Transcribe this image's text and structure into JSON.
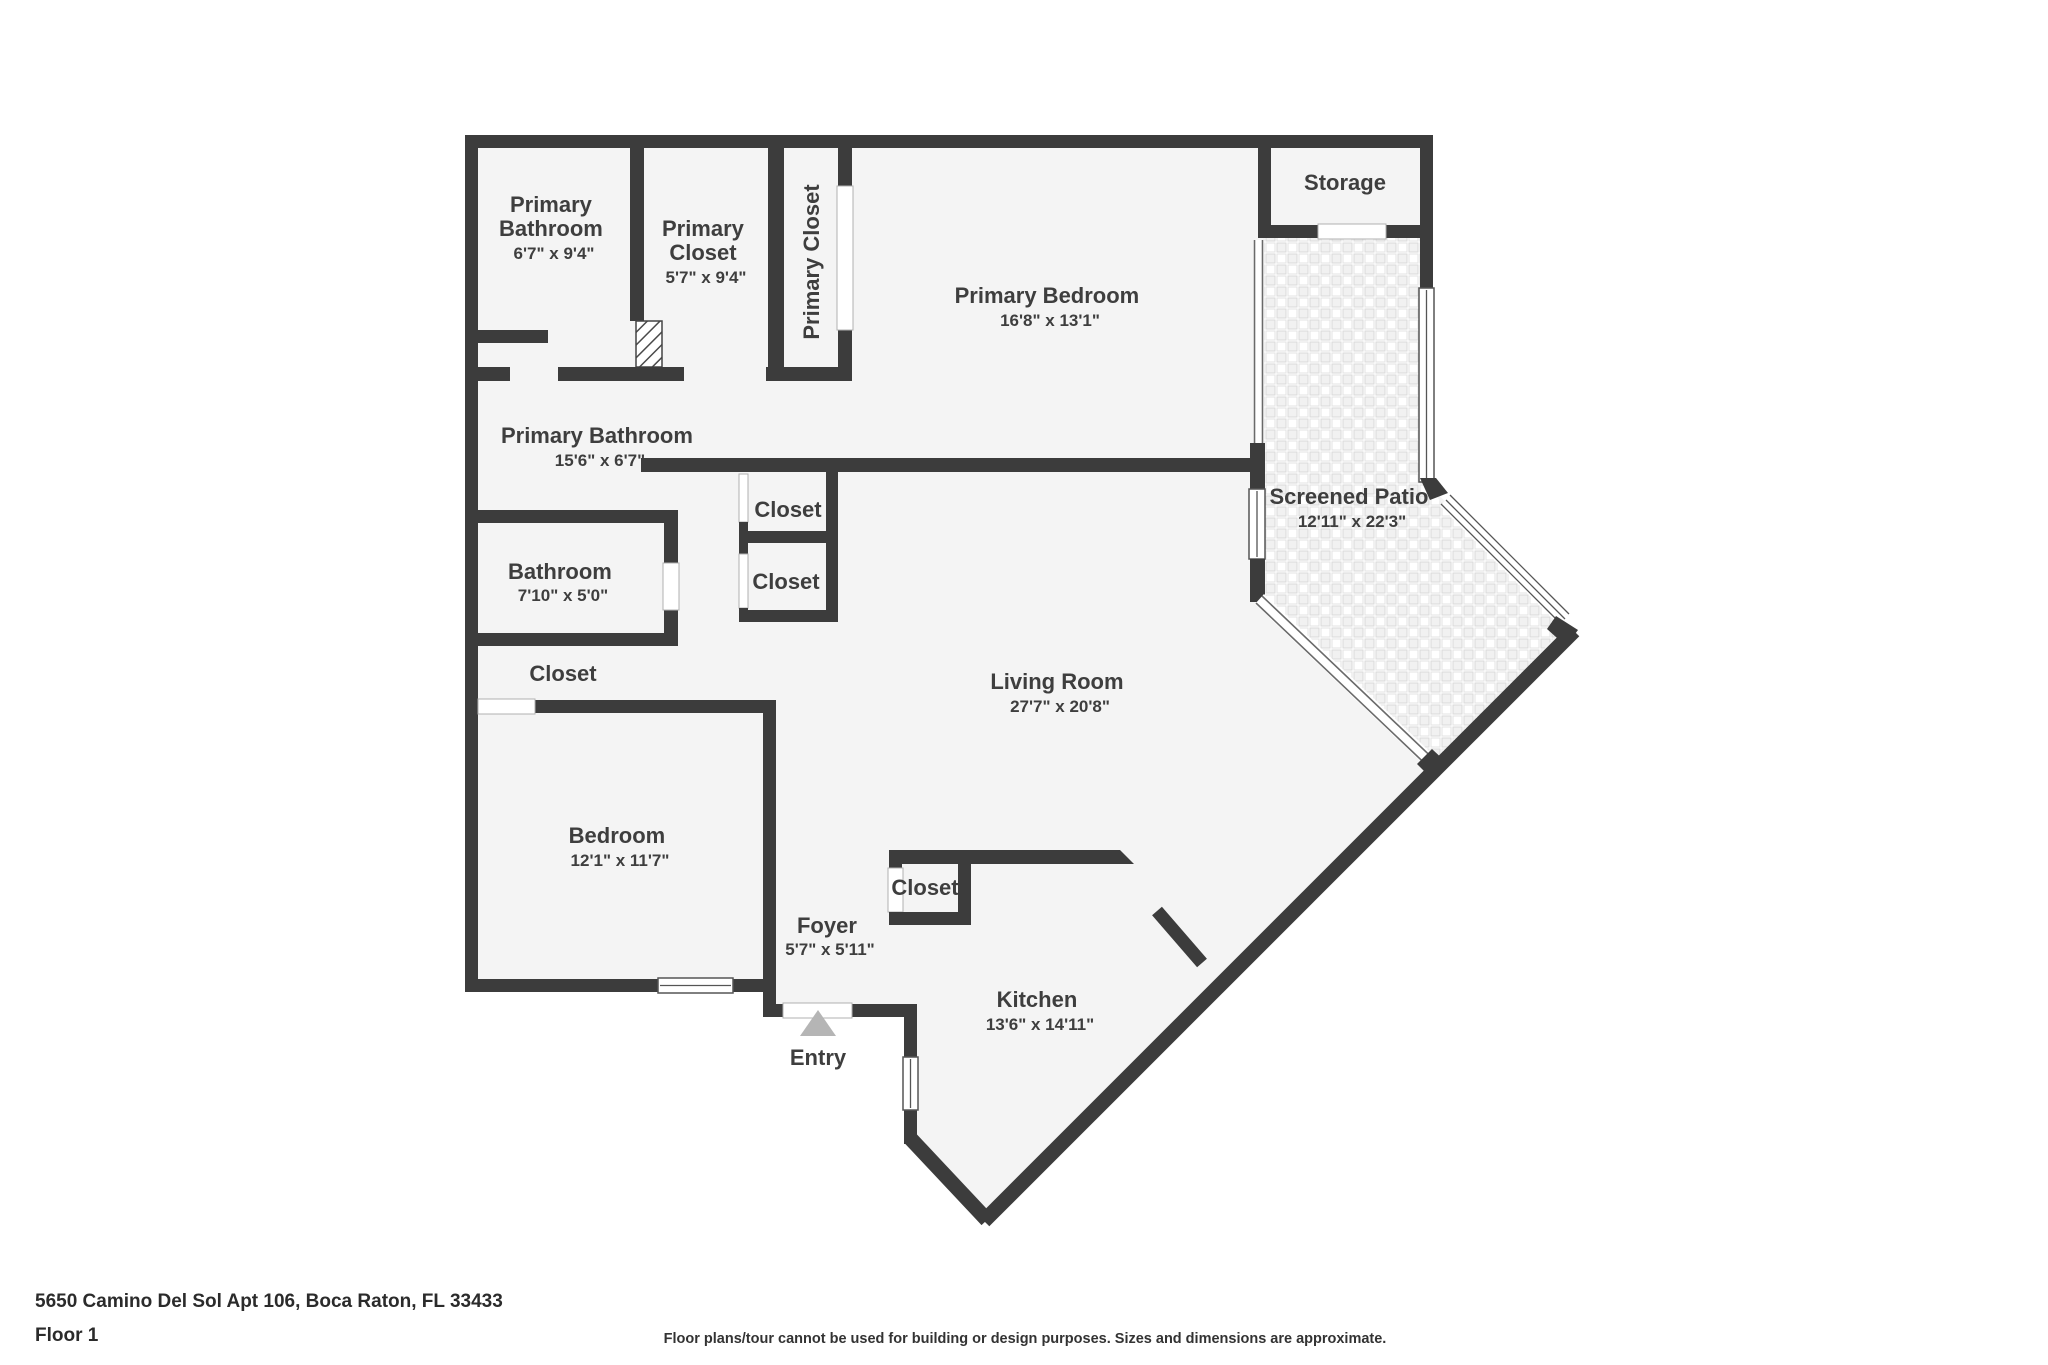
{
  "meta": {
    "address": "5650 Camino Del Sol Apt 106, Boca Raton, FL 33433",
    "floor_label": "Floor 1",
    "disclaimer": "Floor plans/tour cannot be used for building or design purposes. Sizes and dimensions are approximate."
  },
  "colors": {
    "wall": "#3c3c3c",
    "room_fill": "#f4f4f4",
    "label_text": "#3e3e3e",
    "entry_arrow": "#b5b5b5",
    "patio_tile_line": "#d9d9d9",
    "background": "#ffffff"
  },
  "rooms": {
    "primary_bathroom_top": {
      "line1": "Primary",
      "line2": "Bathroom",
      "dims": "6'7\" x 9'4\""
    },
    "primary_closet": {
      "line1": "Primary",
      "line2": "Closet",
      "dims": "5'7\" x 9'4\""
    },
    "primary_closet_vertical": {
      "label": "Primary Closet"
    },
    "primary_bedroom": {
      "label": "Primary Bedroom",
      "dims": "16'8\" x 13'1\""
    },
    "storage": {
      "label": "Storage"
    },
    "primary_bathroom_main": {
      "label": "Primary Bathroom",
      "dims": "15'6\" x 6'7\""
    },
    "closet_hall_top": {
      "label": "Closet"
    },
    "closet_hall_bottom": {
      "label": "Closet"
    },
    "bathroom": {
      "label": "Bathroom",
      "dims": "7'10\" x 5'0\""
    },
    "closet_bedroom_hall": {
      "label": "Closet"
    },
    "bedroom": {
      "label": "Bedroom",
      "dims": "12'1\" x 11'7\""
    },
    "living_room": {
      "label": "Living Room",
      "dims": "27'7\" x 20'8\""
    },
    "screened_patio": {
      "label": "Screened Patio",
      "dims": "12'11\" x 22'3\""
    },
    "foyer": {
      "label": "Foyer",
      "dims": "5'7\" x 5'11\""
    },
    "closet_foyer": {
      "label": "Closet"
    },
    "kitchen": {
      "label": "Kitchen",
      "dims": "13'6\" x 14'11\""
    },
    "entry": {
      "label": "Entry"
    }
  }
}
